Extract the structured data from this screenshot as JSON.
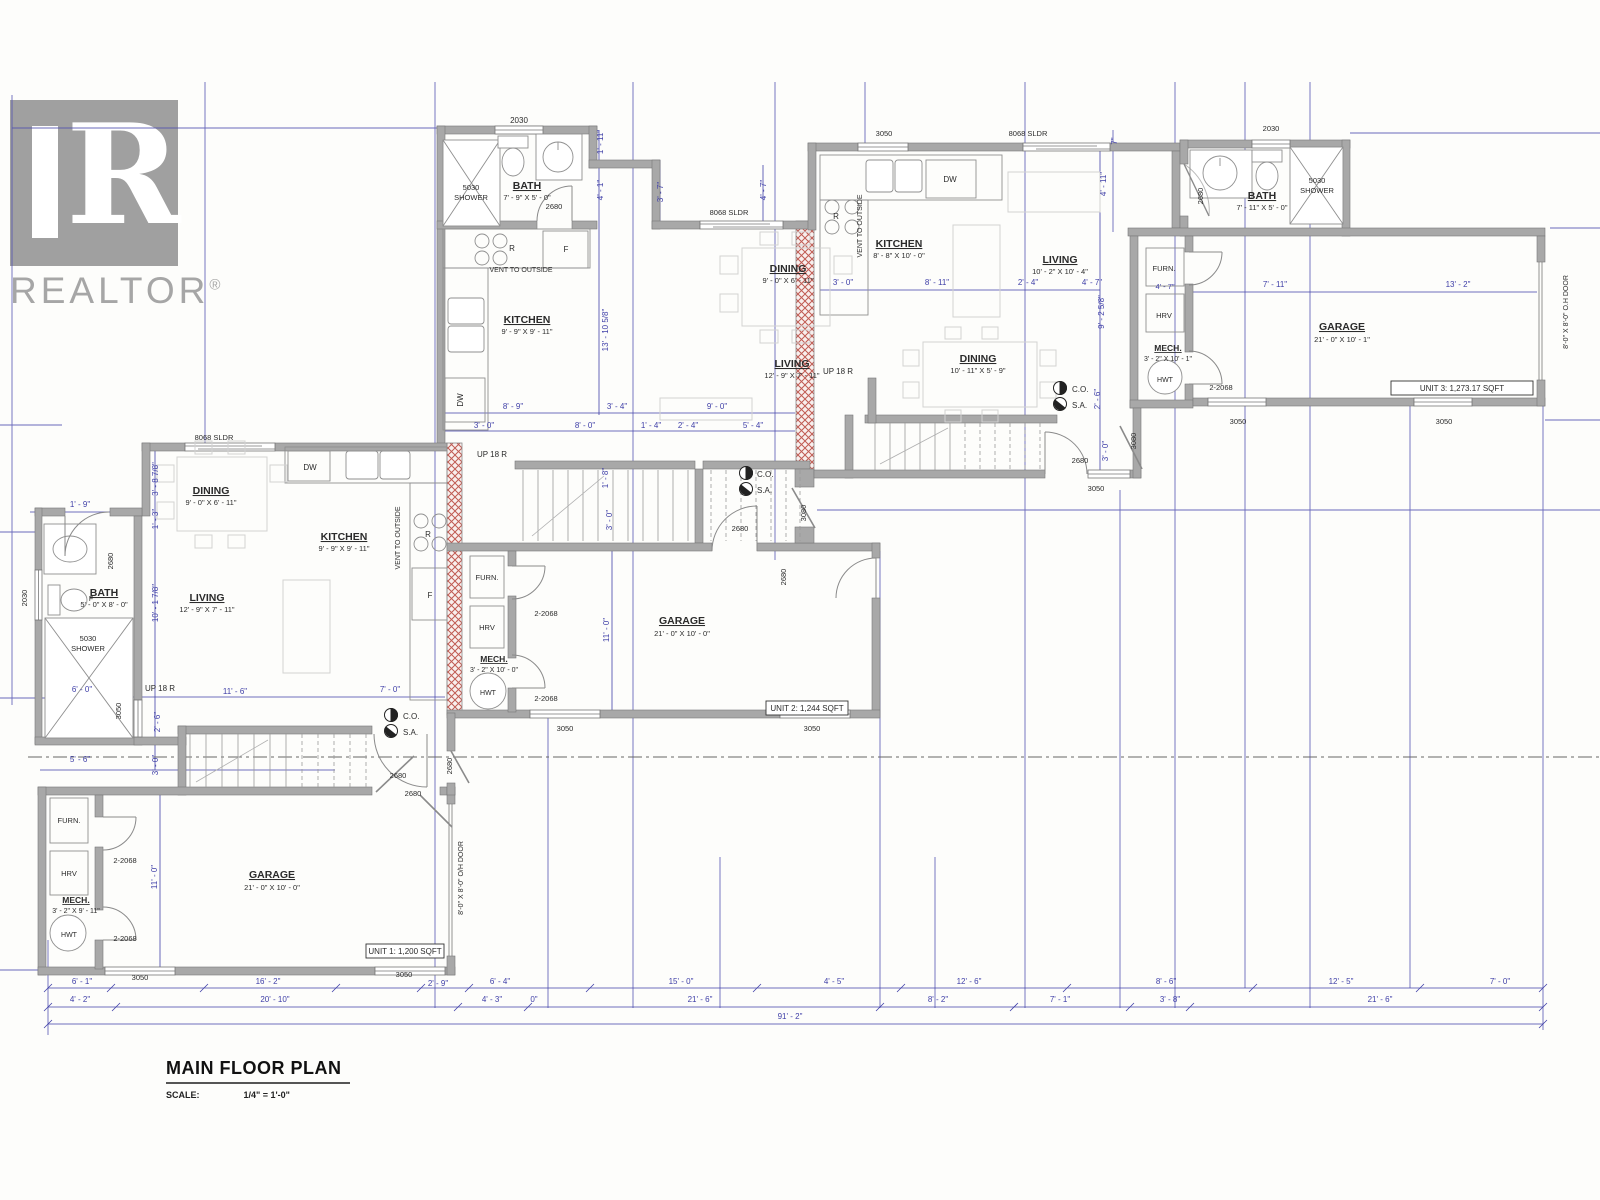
{
  "watermark": {
    "brand": "REALTOR",
    "reg": "®",
    "glyph": "R"
  },
  "title_block": {
    "title": "MAIN FLOOR PLAN",
    "scale_label": "SCALE:",
    "scale_value": "1/4\" = 1'-0\""
  },
  "units_summary": [
    {
      "id": "unit-1",
      "area_label": "UNIT 1: 1,200 SQFT"
    },
    {
      "id": "unit-2",
      "area_label": "UNIT 2: 1,244 SQFT"
    },
    {
      "id": "unit-3",
      "area_label": "UNIT 3: 1,273.17 SQFT"
    }
  ],
  "colors": {
    "dim_blue": "#4040a8",
    "ink": "#2b2b2b",
    "wall_gray": "#a8a8a8",
    "hatch_red": "#c05a52"
  },
  "texts": [
    {
      "t": "2030",
      "x": 519,
      "y": 123,
      "n": "u2-bath-window-tag"
    },
    {
      "t": "5030",
      "x": 471,
      "y": 190,
      "s": 7.5,
      "n": "u2-shower-tag"
    },
    {
      "t": "SHOWER",
      "x": 471,
      "y": 200,
      "s": 7.5
    },
    {
      "t": "BATH",
      "x": 527,
      "y": 189,
      "w": 1,
      "u": 1,
      "s": 10.5,
      "n": "u2-bath-label"
    },
    {
      "t": "7' - 9\" X 5' - 0\"",
      "x": 527,
      "y": 200,
      "s": 7.5
    },
    {
      "t": "2680",
      "x": 554,
      "y": 209,
      "s": 7.5
    },
    {
      "t": "R",
      "x": 512,
      "y": 251,
      "s": 8,
      "n": "u2-range-tag"
    },
    {
      "t": "F",
      "x": 566,
      "y": 252,
      "s": 8,
      "n": "u2-fridge-tag"
    },
    {
      "t": "VENT TO OUTSIDE",
      "x": 521,
      "y": 272,
      "s": 7,
      "n": "u2-vent-note"
    },
    {
      "t": "KITCHEN",
      "x": 527,
      "y": 323,
      "w": 1,
      "u": 1,
      "s": 10.5,
      "n": "u2-kitchen-label"
    },
    {
      "t": "9' - 9\" X 9' - 11\"",
      "x": 527,
      "y": 334,
      "s": 7.5
    },
    {
      "t": "DW",
      "x": 463,
      "y": 400,
      "s": 8,
      "r": -90,
      "n": "u2-dw-tag"
    },
    {
      "t": "8' - 9\"",
      "x": 513,
      "y": 409,
      "c": "b"
    },
    {
      "t": "3' - 4\"",
      "x": 617,
      "y": 409,
      "c": "b"
    },
    {
      "t": "9' - 0\"",
      "x": 717,
      "y": 409,
      "c": "b"
    },
    {
      "t": "3' - 0\"",
      "x": 484,
      "y": 428,
      "c": "b"
    },
    {
      "t": "8' - 0\"",
      "x": 585,
      "y": 428,
      "c": "b"
    },
    {
      "t": "1' - 4\"",
      "x": 651,
      "y": 428,
      "c": "b"
    },
    {
      "t": "2' - 4\"",
      "x": 688,
      "y": 428,
      "c": "b"
    },
    {
      "t": "5' - 4\"",
      "x": 753,
      "y": 428,
      "c": "b"
    },
    {
      "t": "1' - 11\"",
      "x": 603,
      "y": 142,
      "c": "b",
      "r": -90
    },
    {
      "t": "4' - 1\"",
      "x": 603,
      "y": 190,
      "c": "b",
      "r": -90
    },
    {
      "t": "13' - 10 5/8\"",
      "x": 608,
      "y": 330,
      "c": "b",
      "r": -90
    },
    {
      "t": "3' - 7\"",
      "x": 663,
      "y": 192,
      "c": "b",
      "r": -90
    },
    {
      "t": "4' - 7\"",
      "x": 766,
      "y": 190,
      "c": "b",
      "r": -90
    },
    {
      "t": "8068 SLDR",
      "x": 729,
      "y": 215,
      "s": 7.5,
      "n": "u2-sldr-tag"
    },
    {
      "t": "DINING",
      "x": 788,
      "y": 272,
      "w": 1,
      "u": 1,
      "s": 10.5,
      "n": "u2-dining-label"
    },
    {
      "t": "9' - 0\" X 6' - 11\"",
      "x": 788,
      "y": 283,
      "s": 7.5
    },
    {
      "t": "LIVING",
      "x": 792,
      "y": 367,
      "w": 1,
      "u": 1,
      "s": 10.5,
      "n": "u2-living-label"
    },
    {
      "t": "12' - 9\" X 7' - 11\"",
      "x": 792,
      "y": 378,
      "s": 7.5
    },
    {
      "t": "UP  18  R",
      "x": 492,
      "y": 457,
      "s": 8,
      "n": "u2-stairs-up-label"
    },
    {
      "t": "1' - 8\"",
      "x": 608,
      "y": 478,
      "c": "b",
      "r": -90
    },
    {
      "t": "3' - 0\"",
      "x": 612,
      "y": 520,
      "c": "b",
      "r": -90
    },
    {
      "t": "C.O.",
      "x": 757,
      "y": 477,
      "s": 8,
      "a": "s",
      "n": "u2-co-label"
    },
    {
      "t": "S.A.",
      "x": 757,
      "y": 493,
      "s": 8,
      "a": "s",
      "n": "u2-sa-label"
    },
    {
      "t": "2680",
      "x": 740,
      "y": 531,
      "s": 7.5
    },
    {
      "t": "3080",
      "x": 806,
      "y": 513,
      "s": 7.5,
      "r": -90
    },
    {
      "t": "FURN.",
      "x": 487,
      "y": 580,
      "s": 7.5,
      "n": "u2-furnace-label"
    },
    {
      "t": "2-2068",
      "x": 546,
      "y": 616,
      "s": 7.5
    },
    {
      "t": "HRV",
      "x": 487,
      "y": 630,
      "s": 7.5,
      "n": "u2-hrv-label"
    },
    {
      "t": "MECH.",
      "x": 494,
      "y": 662,
      "w": 1,
      "u": 1,
      "s": 8.5,
      "n": "u2-mech-label"
    },
    {
      "t": "3' - 2\" X 10' - 0\"",
      "x": 494,
      "y": 672,
      "s": 7
    },
    {
      "t": "HWT",
      "x": 488,
      "y": 695,
      "s": 7,
      "n": "u2-hwt-label"
    },
    {
      "t": "2-2068",
      "x": 546,
      "y": 701,
      "s": 7.5
    },
    {
      "t": "11' - 0\"",
      "x": 609,
      "y": 630,
      "c": "b",
      "r": -90
    },
    {
      "t": "GARAGE",
      "x": 682,
      "y": 624,
      "w": 1,
      "u": 1,
      "s": 10.5,
      "n": "u2-garage-label"
    },
    {
      "t": "21' - 0\" X 10' - 0\"",
      "x": 682,
      "y": 636,
      "s": 7.5
    },
    {
      "t": "UNIT 2: 1,244 SQFT",
      "x": 807,
      "y": 711,
      "s": 8,
      "n": "unit2-area-label"
    },
    {
      "t": "3050",
      "x": 565,
      "y": 731,
      "s": 7.5
    },
    {
      "t": "3050",
      "x": 812,
      "y": 731,
      "s": 7.5
    },
    {
      "t": "2680",
      "x": 786,
      "y": 577,
      "s": 7.5,
      "r": -90
    },
    {
      "t": "3050",
      "x": 884,
      "y": 136,
      "s": 7.5
    },
    {
      "t": "8068 SLDR",
      "x": 1028,
      "y": 136,
      "s": 7.5,
      "n": "u3-sldr-tag"
    },
    {
      "t": "7\"",
      "x": 1117,
      "y": 141,
      "c": "b",
      "r": -90
    },
    {
      "t": "4' - 11\"",
      "x": 1106,
      "y": 184,
      "c": "b",
      "r": -90
    },
    {
      "t": "DW",
      "x": 950,
      "y": 182,
      "s": 8,
      "n": "u3-dw-tag"
    },
    {
      "t": "R",
      "x": 836,
      "y": 219,
      "s": 8,
      "n": "u3-range-tag"
    },
    {
      "t": "VENT TO OUTSIDE",
      "x": 862,
      "y": 226,
      "s": 7,
      "r": -90,
      "n": "u3-vent-note"
    },
    {
      "t": "KITCHEN",
      "x": 899,
      "y": 247,
      "w": 1,
      "u": 1,
      "s": 10.5,
      "n": "u3-kitchen-label"
    },
    {
      "t": "8' - 8\" X 10' - 0\"",
      "x": 899,
      "y": 258,
      "s": 7.5
    },
    {
      "t": "LIVING",
      "x": 1060,
      "y": 263,
      "w": 1,
      "u": 1,
      "s": 10.5,
      "n": "u3-living-label"
    },
    {
      "t": "10' - 2\" X 10' - 4\"",
      "x": 1060,
      "y": 274,
      "s": 7.5
    },
    {
      "t": "3' - 0\"",
      "x": 843,
      "y": 285,
      "c": "b"
    },
    {
      "t": "8' - 11\"",
      "x": 937,
      "y": 285,
      "c": "b"
    },
    {
      "t": "2' - 4\"",
      "x": 1028,
      "y": 285,
      "c": "b"
    },
    {
      "t": "4' - 7\"",
      "x": 1092,
      "y": 285,
      "c": "b"
    },
    {
      "t": "9' - 2 5/8\"",
      "x": 1104,
      "y": 312,
      "c": "b",
      "r": -90
    },
    {
      "t": "DINING",
      "x": 978,
      "y": 362,
      "w": 1,
      "u": 1,
      "s": 10.5,
      "n": "u3-dining-label"
    },
    {
      "t": "10' - 11\" X 5' - 9\"",
      "x": 978,
      "y": 373,
      "s": 7.5
    },
    {
      "t": "UP  18  R",
      "x": 838,
      "y": 374,
      "s": 8,
      "n": "u3-stairs-up-label"
    },
    {
      "t": "C.O.",
      "x": 1072,
      "y": 392,
      "s": 8,
      "a": "s",
      "n": "u3-co-label"
    },
    {
      "t": "S.A.",
      "x": 1072,
      "y": 408,
      "s": 8,
      "a": "s",
      "n": "u3-sa-label"
    },
    {
      "t": "2' - 6\"",
      "x": 1100,
      "y": 399,
      "c": "b",
      "r": -90
    },
    {
      "t": "2680",
      "x": 1080,
      "y": 463,
      "s": 7.5
    },
    {
      "t": "3' - 0\"",
      "x": 1108,
      "y": 451,
      "c": "b",
      "r": -90
    },
    {
      "t": "3080",
      "x": 1136,
      "y": 441,
      "s": 7.5,
      "r": -90
    },
    {
      "t": "3050",
      "x": 1096,
      "y": 491,
      "s": 7.5
    },
    {
      "t": "FURN.",
      "x": 1164,
      "y": 271,
      "s": 7.5,
      "n": "u3-furnace-label"
    },
    {
      "t": "4' - 7\"",
      "x": 1165,
      "y": 289,
      "c": "b",
      "s": 7.5
    },
    {
      "t": "HRV",
      "x": 1164,
      "y": 318,
      "s": 7.5,
      "n": "u3-hrv-label"
    },
    {
      "t": "MECH.",
      "x": 1168,
      "y": 351,
      "w": 1,
      "u": 1,
      "s": 8.5,
      "n": "u3-mech-label"
    },
    {
      "t": "3' - 2\" X 10' - 1\"",
      "x": 1168,
      "y": 361,
      "s": 7
    },
    {
      "t": "HWT",
      "x": 1165,
      "y": 382,
      "s": 7,
      "n": "u3-hwt-label"
    },
    {
      "t": "2-2068",
      "x": 1221,
      "y": 390,
      "s": 7.5
    },
    {
      "t": "2030",
      "x": 1271,
      "y": 131,
      "s": 7.5
    },
    {
      "t": "2680",
      "x": 1203,
      "y": 196,
      "s": 7.5,
      "r": -90
    },
    {
      "t": "BATH",
      "x": 1262,
      "y": 199,
      "w": 1,
      "u": 1,
      "s": 10.5,
      "n": "u3-bath-label"
    },
    {
      "t": "7' - 11\" X 5' - 0\"",
      "x": 1262,
      "y": 210,
      "s": 7.5
    },
    {
      "t": "5030",
      "x": 1317,
      "y": 183,
      "s": 7.5,
      "n": "u3-shower-tag"
    },
    {
      "t": "SHOWER",
      "x": 1317,
      "y": 193,
      "s": 7.5
    },
    {
      "t": "7' - 11\"",
      "x": 1275,
      "y": 287,
      "c": "b"
    },
    {
      "t": "13' - 2\"",
      "x": 1458,
      "y": 287,
      "c": "b"
    },
    {
      "t": "GARAGE",
      "x": 1342,
      "y": 330,
      "w": 1,
      "u": 1,
      "s": 10.5,
      "n": "u3-garage-label"
    },
    {
      "t": "21' - 0\" X 10' - 1\"",
      "x": 1342,
      "y": 342,
      "s": 7.5
    },
    {
      "t": "UNIT 3: 1,273.17 SQFT",
      "x": 1462,
      "y": 391,
      "s": 8,
      "n": "unit3-area-label"
    },
    {
      "t": "3050",
      "x": 1238,
      "y": 424,
      "s": 7.5
    },
    {
      "t": "3050",
      "x": 1444,
      "y": 424,
      "s": 7.5
    },
    {
      "t": "8'-0\" X 8'-0\" O.H DOOR",
      "x": 1568,
      "y": 312,
      "s": 7,
      "r": -90,
      "n": "unit3-ohdoor-note"
    },
    {
      "t": "8068 SLDR",
      "x": 214,
      "y": 440,
      "s": 7.5,
      "n": "u1-sldr-tag"
    },
    {
      "t": "3' - 8 7/8\"",
      "x": 158,
      "y": 479,
      "c": "b",
      "r": -90
    },
    {
      "t": "DINING",
      "x": 211,
      "y": 494,
      "w": 1,
      "u": 1,
      "s": 10.5,
      "n": "u1-dining-label"
    },
    {
      "t": "9' - 0\" X 6' - 11\"",
      "x": 211,
      "y": 505,
      "s": 7.5
    },
    {
      "t": "DW",
      "x": 310,
      "y": 470,
      "s": 8,
      "n": "u1-dw-tag"
    },
    {
      "t": "1' - 3\"",
      "x": 158,
      "y": 519,
      "c": "b",
      "r": -90
    },
    {
      "t": "KITCHEN",
      "x": 344,
      "y": 540,
      "w": 1,
      "u": 1,
      "s": 10.5,
      "n": "u1-kitchen-label"
    },
    {
      "t": "9' - 9\" X 9' - 11\"",
      "x": 344,
      "y": 551,
      "s": 7.5
    },
    {
      "t": "VENT TO OUTSIDE",
      "x": 400,
      "y": 538,
      "s": 7,
      "r": -90,
      "n": "u1-vent-note"
    },
    {
      "t": "R",
      "x": 428,
      "y": 537,
      "s": 8,
      "n": "u1-range-tag"
    },
    {
      "t": "F",
      "x": 430,
      "y": 598,
      "s": 8,
      "n": "u1-fridge-tag"
    },
    {
      "t": "1' - 9\"",
      "x": 80,
      "y": 507,
      "c": "b"
    },
    {
      "t": "2030",
      "x": 27,
      "y": 598,
      "s": 7.5,
      "r": -90
    },
    {
      "t": "2680",
      "x": 113,
      "y": 561,
      "s": 7.5,
      "r": -90
    },
    {
      "t": "BATH",
      "x": 104,
      "y": 596,
      "w": 1,
      "u": 1,
      "s": 10.5,
      "n": "u1-bath-label"
    },
    {
      "t": "5' - 0\" X 8' - 0\"",
      "x": 104,
      "y": 607,
      "s": 7.5
    },
    {
      "t": "F",
      "x": 91,
      "y": 601,
      "s": 7
    },
    {
      "t": "5030",
      "x": 88,
      "y": 641,
      "s": 7.5,
      "n": "u1-shower-tag"
    },
    {
      "t": "SHOWER",
      "x": 88,
      "y": 651,
      "s": 7.5
    },
    {
      "t": "10' - 1 7/8\"",
      "x": 158,
      "y": 603,
      "c": "b",
      "r": -90
    },
    {
      "t": "LIVING",
      "x": 207,
      "y": 601,
      "w": 1,
      "u": 1,
      "s": 10.5,
      "n": "u1-living-label"
    },
    {
      "t": "12' - 9\" X 7' - 11\"",
      "x": 207,
      "y": 612,
      "s": 7.5
    },
    {
      "t": "6' - 0\"",
      "x": 82,
      "y": 692,
      "c": "b"
    },
    {
      "t": "UP  18  R",
      "x": 160,
      "y": 691,
      "s": 8,
      "n": "u1-stairs-up-label"
    },
    {
      "t": "3050",
      "x": 121,
      "y": 711,
      "s": 7.5,
      "r": -90
    },
    {
      "t": "2' - 6\"",
      "x": 160,
      "y": 722,
      "c": "b",
      "r": -90
    },
    {
      "t": "11' - 6\"",
      "x": 235,
      "y": 694,
      "c": "b"
    },
    {
      "t": "7' - 0\"",
      "x": 390,
      "y": 692,
      "c": "b"
    },
    {
      "t": "C.O.",
      "x": 403,
      "y": 719,
      "s": 8,
      "a": "s",
      "n": "u1-co-label"
    },
    {
      "t": "S.A.",
      "x": 403,
      "y": 735,
      "s": 8,
      "a": "s",
      "n": "u1-sa-label"
    },
    {
      "t": "5' - 6\"",
      "x": 80,
      "y": 762,
      "c": "b"
    },
    {
      "t": "3' - 0\"",
      "x": 158,
      "y": 765,
      "c": "b",
      "r": -90
    },
    {
      "t": "2680",
      "x": 398,
      "y": 778,
      "s": 7.5
    },
    {
      "t": "2680",
      "x": 413,
      "y": 796,
      "s": 7.5
    },
    {
      "t": "2680",
      "x": 452,
      "y": 766,
      "s": 7.5,
      "r": -90
    },
    {
      "t": "FURN.",
      "x": 69,
      "y": 823,
      "s": 7.5,
      "n": "u1-furnace-label"
    },
    {
      "t": "2-2068",
      "x": 125,
      "y": 863,
      "s": 7.5
    },
    {
      "t": "HRV",
      "x": 69,
      "y": 876,
      "s": 7.5,
      "n": "u1-hrv-label"
    },
    {
      "t": "MECH.",
      "x": 76,
      "y": 903,
      "w": 1,
      "u": 1,
      "s": 8.5,
      "n": "u1-mech-label"
    },
    {
      "t": "3' - 2\" X 9' - 11\"",
      "x": 76,
      "y": 913,
      "s": 7
    },
    {
      "t": "HWT",
      "x": 69,
      "y": 937,
      "s": 7,
      "n": "u1-hwt-label"
    },
    {
      "t": "2-2068",
      "x": 125,
      "y": 941,
      "s": 7.5
    },
    {
      "t": "11' - 0\"",
      "x": 157,
      "y": 877,
      "c": "b",
      "r": -90
    },
    {
      "t": "GARAGE",
      "x": 272,
      "y": 878,
      "w": 1,
      "u": 1,
      "s": 10.5,
      "n": "u1-garage-label"
    },
    {
      "t": "21' - 0\" X 10' - 0\"",
      "x": 272,
      "y": 890,
      "s": 7.5
    },
    {
      "t": "UNIT 1: 1,200 SQFT",
      "x": 405,
      "y": 954,
      "s": 8,
      "n": "unit1-area-label"
    },
    {
      "t": "8'-0\" X 8'-0\" O/H DOOR",
      "x": 463,
      "y": 878,
      "s": 7,
      "r": -90,
      "n": "unit1-ohdoor-note"
    },
    {
      "t": "3050",
      "x": 140,
      "y": 980,
      "s": 7.5
    },
    {
      "t": "3050",
      "x": 404,
      "y": 977,
      "s": 7.5
    },
    {
      "t": "6' - 1\"",
      "x": 82,
      "y": 984,
      "c": "b"
    },
    {
      "t": "16' - 2\"",
      "x": 268,
      "y": 984,
      "c": "b"
    },
    {
      "t": "2' - 9\"",
      "x": 438,
      "y": 986,
      "c": "b"
    },
    {
      "t": "6' - 4\"",
      "x": 500,
      "y": 984,
      "c": "b"
    },
    {
      "t": "15' - 0\"",
      "x": 681,
      "y": 984,
      "c": "b"
    },
    {
      "t": "4' - 5\"",
      "x": 834,
      "y": 984,
      "c": "b"
    },
    {
      "t": "12' - 6\"",
      "x": 969,
      "y": 984,
      "c": "b"
    },
    {
      "t": "8' - 6\"",
      "x": 1166,
      "y": 984,
      "c": "b"
    },
    {
      "t": "12' - 5\"",
      "x": 1341,
      "y": 984,
      "c": "b"
    },
    {
      "t": "7' - 0\"",
      "x": 1500,
      "y": 984,
      "c": "b"
    },
    {
      "t": "4' - 2\"",
      "x": 80,
      "y": 1002,
      "c": "b"
    },
    {
      "t": "20' - 10\"",
      "x": 275,
      "y": 1002,
      "c": "b"
    },
    {
      "t": "4' - 3\"",
      "x": 492,
      "y": 1002,
      "c": "b"
    },
    {
      "t": "0\"",
      "x": 534,
      "y": 1002,
      "c": "b"
    },
    {
      "t": "21' - 6\"",
      "x": 700,
      "y": 1002,
      "c": "b"
    },
    {
      "t": "8' - 2\"",
      "x": 938,
      "y": 1002,
      "c": "b"
    },
    {
      "t": "7' - 1\"",
      "x": 1060,
      "y": 1002,
      "c": "b"
    },
    {
      "t": "3' - 8\"",
      "x": 1170,
      "y": 1002,
      "c": "b"
    },
    {
      "t": "21' - 6\"",
      "x": 1380,
      "y": 1002,
      "c": "b"
    },
    {
      "t": "91' - 2\"",
      "x": 790,
      "y": 1019,
      "c": "b"
    }
  ]
}
